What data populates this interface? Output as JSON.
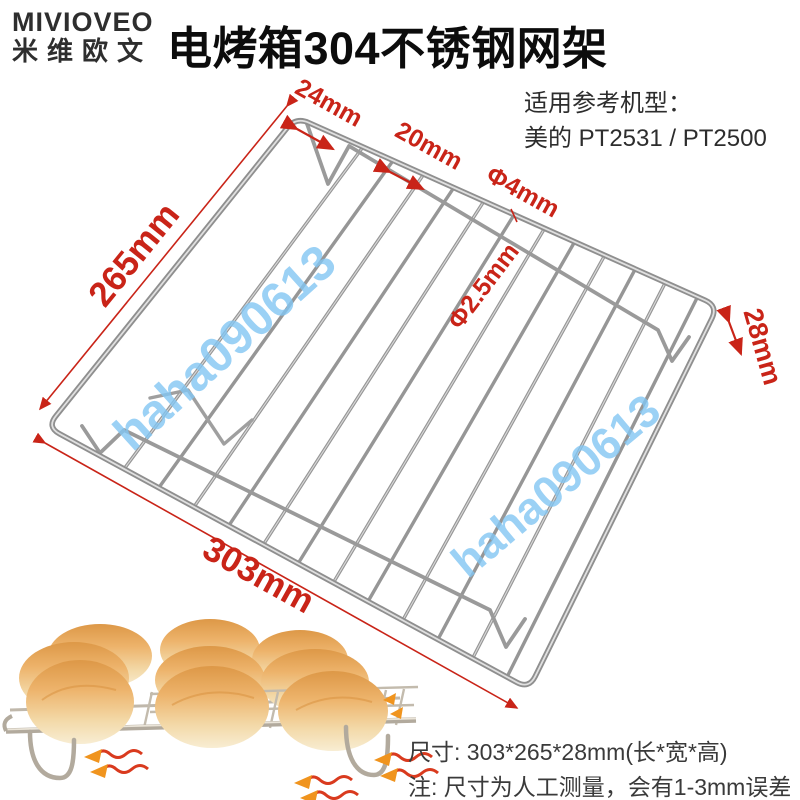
{
  "brand": {
    "name": "MIVIOVEO",
    "name_cn": "米维欧文"
  },
  "header": {
    "title": "电烤箱304不锈钢网架"
  },
  "compat": {
    "heading": "适用参考机型：",
    "models": "美的 PT2531 / PT2500"
  },
  "diagram": {
    "width_label": "265mm",
    "length_label": "303mm",
    "height_label": "28mm",
    "edge_gap_label": "24mm",
    "wire_spacing_label": "20mm",
    "frame_wire_label": "Φ4mm",
    "grid_wire_label": "Φ2.5mm",
    "annotation_color": "#c92418",
    "metal_color": "#9a9a9a"
  },
  "watermark": {
    "text": "haha090613",
    "color": "#84c6f2"
  },
  "footer": {
    "size_line": "尺寸: 303*265*28mm(长*宽*高)",
    "note_line": "注: 尺寸为人工测量，会有1-3mm误差"
  }
}
